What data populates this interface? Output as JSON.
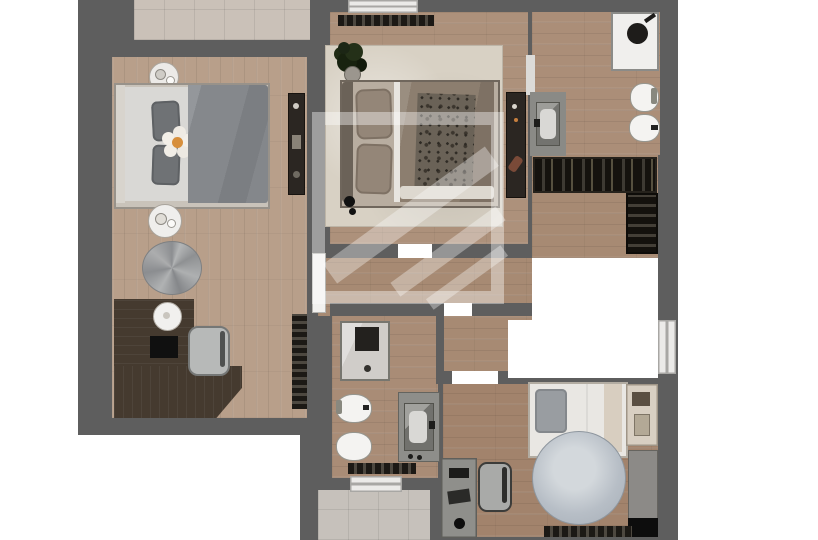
{
  "colors": {
    "wall": "#5e5e5e",
    "floor_bedroom_left": "#b89f8a",
    "floor_bedroom_mid": "#ad917b",
    "floor_bathroom_top": "#ab8e78",
    "floor_hall": "#a78a73",
    "floor_bedroom_bottom": "#a2836c",
    "floor_bathroom_bottom": "#a98c76",
    "balcony_tile": "#cac1b8",
    "terrace_tile": "#c6c1bb",
    "rug_cream": "#d8d1c4",
    "rug_blue_gray": "#b7bec6",
    "duvet_gray": "#85888c",
    "duvet_taupe": "#8c7e6f",
    "bed_white": "#e9e7e3",
    "fixture_white": "#f0efed",
    "furniture_dark": "#2b2622",
    "desk_walnut": "#453a2f",
    "furniture_gray": "#8f8f8b",
    "shower_tile": "#d0cdc9",
    "flower_center": "#d78f3c",
    "plant_green": "#1c2615"
  },
  "plan": {
    "type": "2d-floor-plan-render",
    "view": "top-down",
    "rooms": [
      {
        "name": "balcony-top",
        "furniture": []
      },
      {
        "name": "bedroom-left",
        "furniture": [
          "double-bed",
          "flower-pillow",
          "side-table",
          "coffee-table",
          "bean-bag",
          "corner-desk",
          "desk-lamp",
          "laptop",
          "desk-chair",
          "wall-console",
          "radiator"
        ]
      },
      {
        "name": "bedroom-middle",
        "furniture": [
          "double-bed",
          "area-rug",
          "plant",
          "radiator",
          "dresser",
          "floor-lamp"
        ]
      },
      {
        "name": "bathroom-top-right",
        "furniture": [
          "shower",
          "toilet",
          "bidet",
          "vanity-sink"
        ]
      },
      {
        "name": "stair-hall",
        "furniture": [
          "wardrobe-rail",
          "staircase"
        ]
      },
      {
        "name": "hallway-landing",
        "furniture": []
      },
      {
        "name": "bathroom-bottom",
        "furniture": [
          "shower",
          "toilet",
          "bidet",
          "vanity-sink",
          "radiator",
          "window"
        ]
      },
      {
        "name": "bedroom-bottom-right",
        "furniture": [
          "single-bed",
          "nightstand",
          "desk",
          "desk-chair",
          "round-rug",
          "wardrobe",
          "radiator"
        ]
      },
      {
        "name": "terrace-bottom",
        "furniture": []
      }
    ],
    "features": [
      "stairwell-void",
      "watermark-logo",
      "door-openings",
      "windows"
    ]
  }
}
